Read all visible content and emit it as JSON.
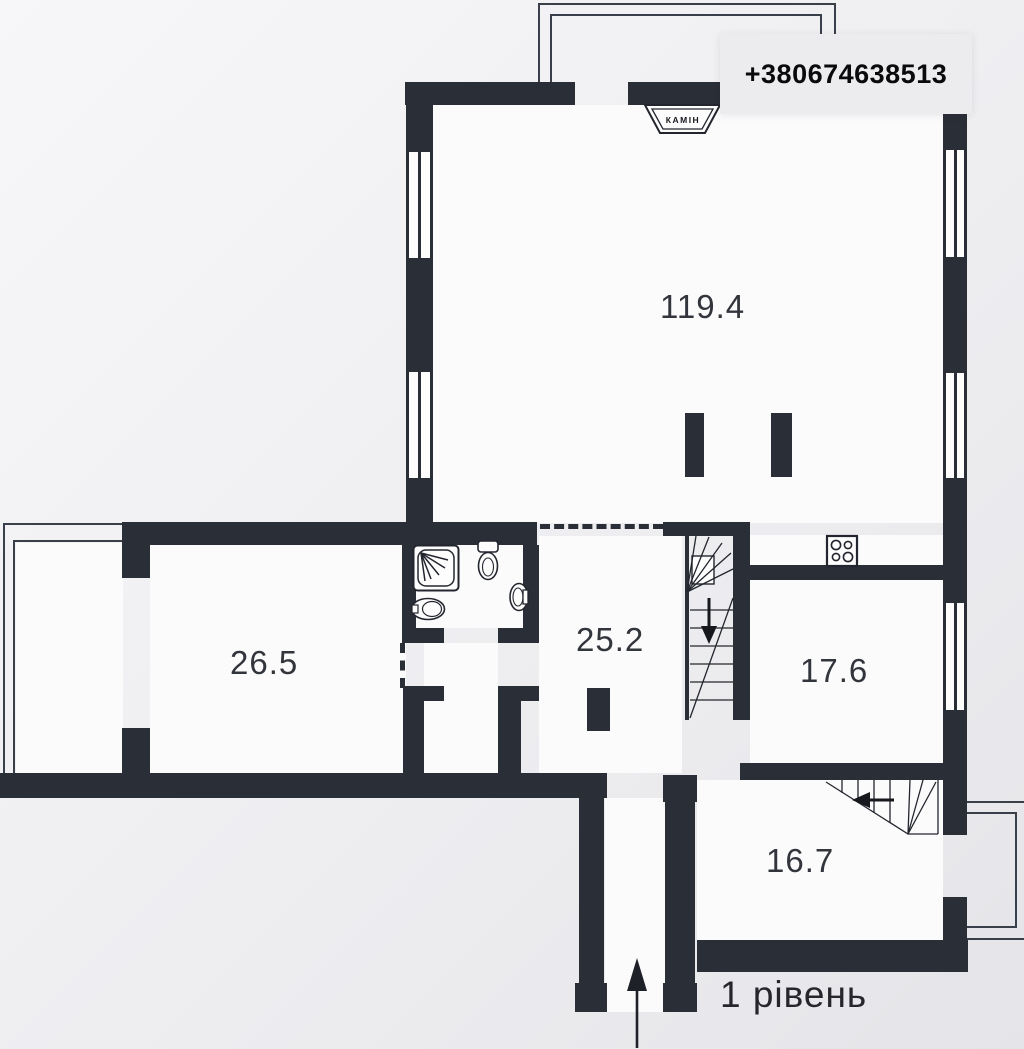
{
  "phone": "+380674638513",
  "level_label": "1 рівень",
  "fireplace_label": "КАМІН",
  "rooms": {
    "living": {
      "area": "119.4"
    },
    "bedroom": {
      "area": "26.5"
    },
    "hall": {
      "area": "25.2"
    },
    "kitchen": {
      "area": "17.6"
    },
    "lower_room": {
      "area": "16.7"
    }
  },
  "colors": {
    "wall": "#2a2e37",
    "thin_line": "#3a404a",
    "label_text": "#33353c",
    "phone_box_bg": "#ececee",
    "phone_text": "#0a0a0d",
    "background_top": "#f7f7f9",
    "background_bottom": "#e5e5e9",
    "room_fill": "#fbfbfc"
  }
}
